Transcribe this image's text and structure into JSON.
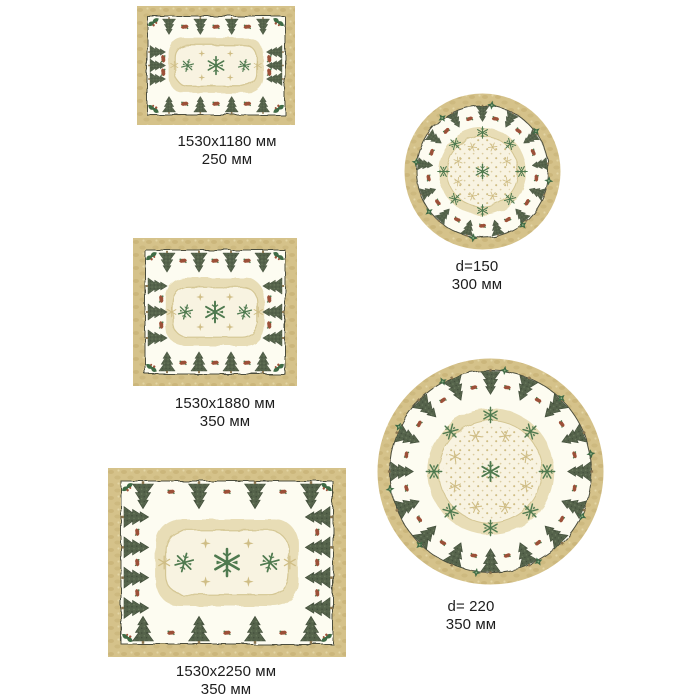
{
  "page": {
    "background": "#ffffff",
    "description": "tablecloth size catalog sheet"
  },
  "products": [
    {
      "id": "rect-small",
      "shape": "rectangle",
      "size": "1530x1180 мм",
      "height": "250 мм"
    },
    {
      "id": "round-small",
      "shape": "round",
      "size": "d=150",
      "height": "300 мм"
    },
    {
      "id": "rect-medium",
      "shape": "rectangle",
      "size": "1530x1880 мм",
      "height": "350 мм"
    },
    {
      "id": "round-large",
      "shape": "round",
      "size": "d= 220",
      "height": "350 мм"
    },
    {
      "id": "rect-large",
      "shape": "rectangle",
      "size": "1530x2250 мм",
      "height": "350 мм"
    }
  ],
  "palette": {
    "tan": "#d5c28a",
    "tan_shade": "#c4ae72",
    "tan_light": "#e7d9ab",
    "outline": "#4c4e3d",
    "cream": "#fdfcf1",
    "lace": "#e8ddb6",
    "lace_light": "#f8f3e1",
    "gold": "#cfbd85",
    "gold_line": "#d4c693",
    "tree": "#55634b",
    "tree_light": "#6d7d5f",
    "tree_dark": "#3e4a37",
    "trunk": "#8a7550",
    "green": "#4f7a4f",
    "green_dark": "#3f6b45",
    "green_light": "#8fae84",
    "red": "#9c5038",
    "text": "#1d1d1d"
  }
}
